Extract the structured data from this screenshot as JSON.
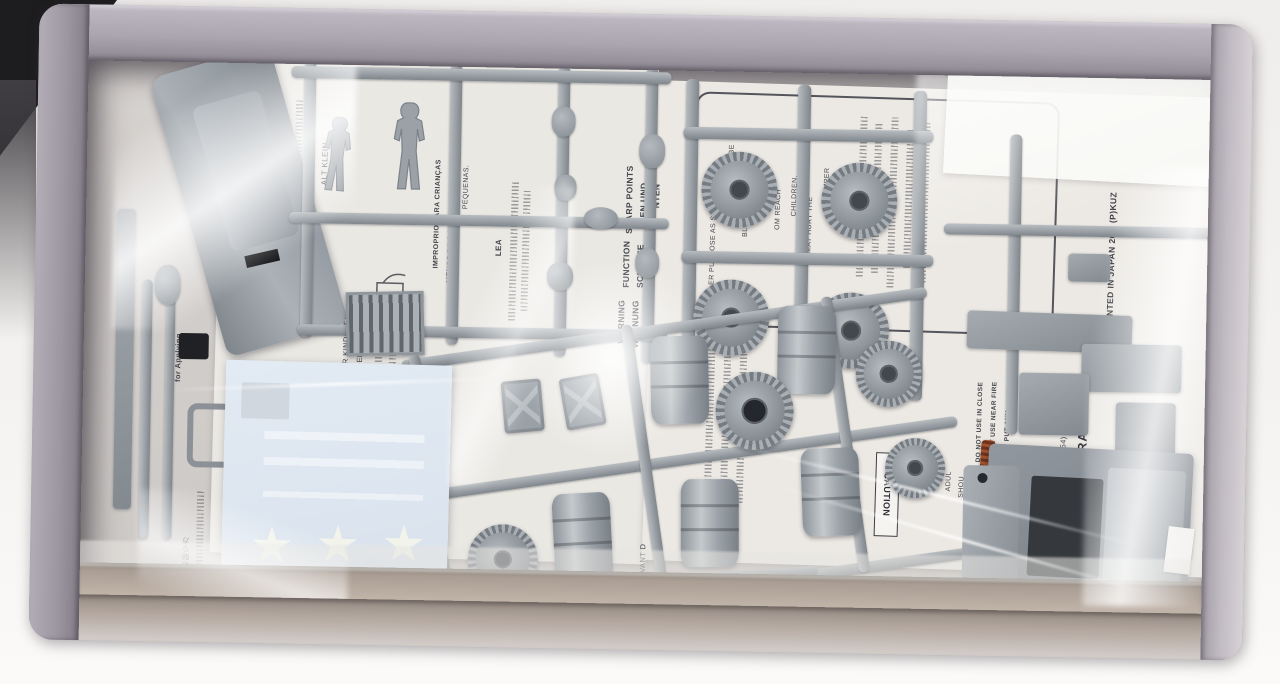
{
  "palette": {
    "backdrop": "#f3f1ef",
    "box_wall": "#aba5af",
    "box_floor": "#a99d93",
    "sprue_gray": "#9ba1a7",
    "paper": "#eae8e3",
    "decal_blue": "#dde6f0",
    "star_white": "#f2f4ec",
    "copper_wire": "#a3532f",
    "shadow_corner": "#1d1c1f"
  },
  "sheet_left": {
    "jp_header": "デカールの貼り方",
    "applying_fragment": "for Applying",
    "decal_instructions": "Move design to exact position with wet finger tip, and push out excess water and air bubbles under decal with soft cotton cloth.",
    "lea_fragment": "LEA",
    "pt_line_1": "IMPRÓPRIO PARA CRIANÇAS",
    "pt_line_2": "MENOS DE 3 ANOS. CONTÉM PEÇAS",
    "pt_line_3": "PEQUENAS.",
    "nl_line_1": "VOOR KINDEREN",
    "nl_line_2": "E ONDERDELEN.",
    "de_fragment": "ALT KLEIN",
    "warning_en": "WARNING",
    "warning_de": "WARNUNG",
    "function_fragment": "FUNCTION",
    "scharfe_fragment": "SCHARFE",
    "sharp_fragment": "SHARP POINTS",
    "kanten_fragment_1": "KEN UND",
    "kanten_fragment_2": "NTEN",
    "fr_fragment": "LIRE CECI AVANT D"
  },
  "sheet_right": {
    "caution": "CAUTION",
    "warn_fragments": [
      "ER PURPOSE AS SOME PA",
      "MAY BE",
      "BLES WITH",
      "S KEE",
      "OM REACH",
      "CHILDREN.",
      "MAY HURT THE",
      "MPER",
      "NTS."
    ],
    "do_not_lines": [
      "DO NOT USE IN CLOSE",
      "DO NOT USE NEAR FIRE",
      "DO NOT PUT ANY"
    ],
    "small_fragments": [
      "ELO",
      "BLIN",
      "ADUL",
      "SHOU",
      "READ"
    ],
    "brand_fragment": "WA CORPORATION",
    "tel": "TEL (054) 628-8241",
    "address_fragment": "8711 Japan.",
    "printed_fragment": "PRINTED IN JAPAN 20M (P)KUZ"
  },
  "decal": {
    "star_count": 3
  }
}
